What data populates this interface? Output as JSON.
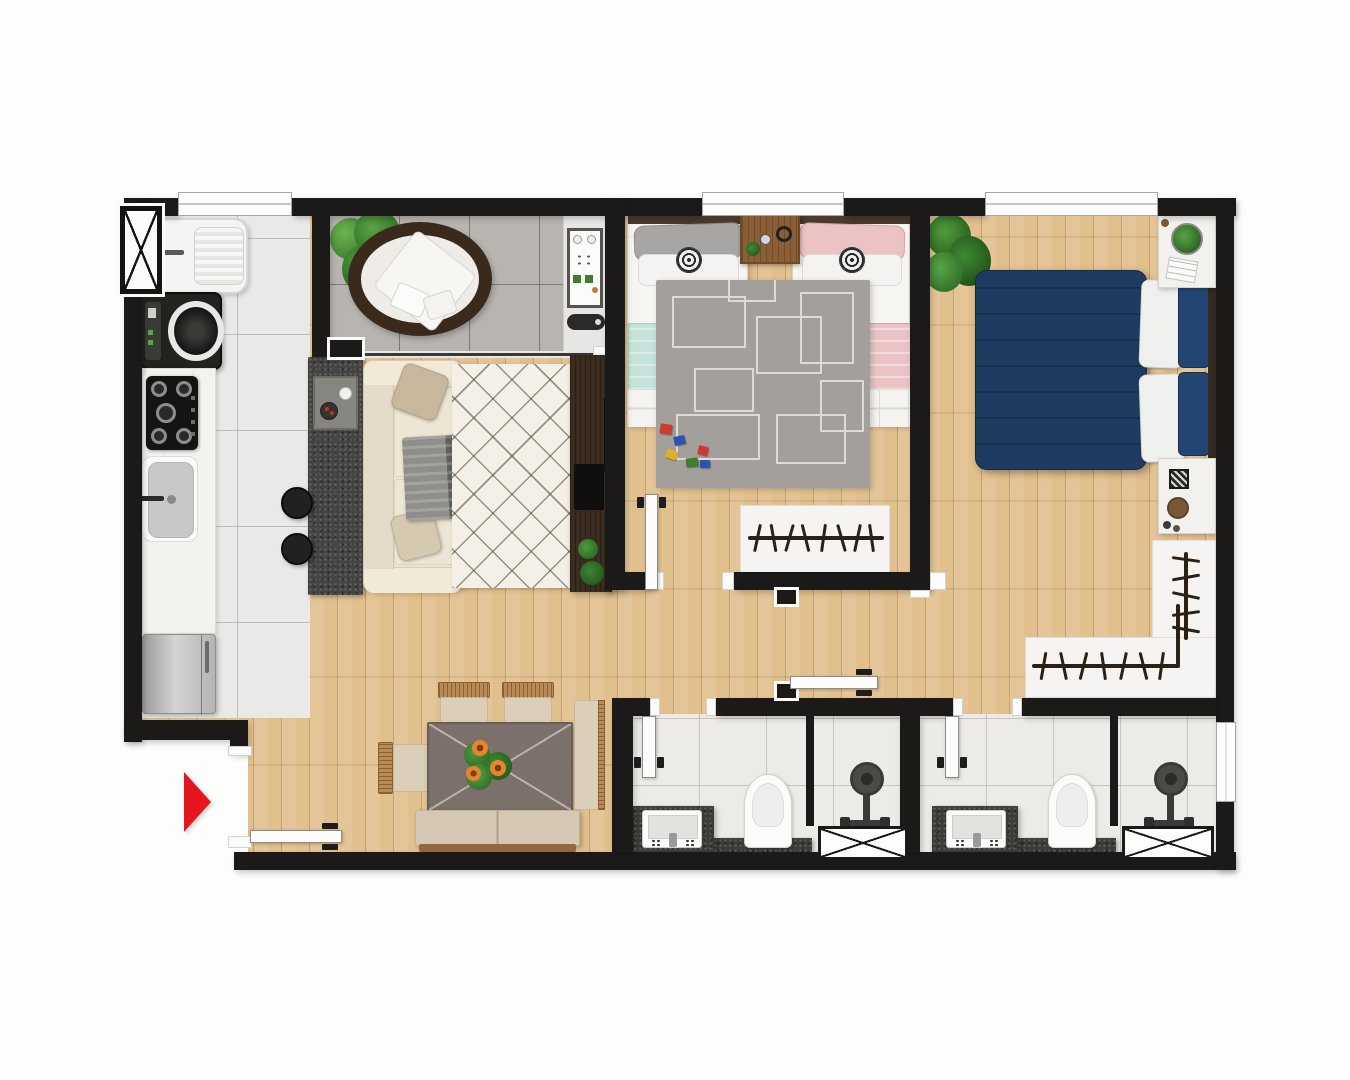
{
  "meta": {
    "title": "Top-down 3D rendered floor plan of a 2-bedroom apartment",
    "view": "top-down architectural render",
    "visible_text": "none"
  },
  "palette": {
    "wall": "#1b1a19",
    "wood_floor": "#e2c08e",
    "balcony_tile": "#b8b5b1",
    "kitchen_tile": "#ebe9e7",
    "bath_tile": "#edebe7",
    "granite_counter": "#454443",
    "navy_bed": "#1e3c61",
    "teal_blanket": "#c4e3da",
    "pink_blanket": "#eac3c4",
    "sofa_cream": "#ebe4d4",
    "entry_arrow_red": "#e5171c",
    "tv_panel_walnut": "#3a2c1f"
  },
  "entry": {
    "marker": "red-arrow",
    "direction": "pointing-right",
    "color": "#e5171c"
  },
  "rooms": [
    {
      "id": "balcony",
      "name": "balcony-terrace",
      "floor": "gray-tile",
      "items": [
        "potted-plant",
        "round-wicker-chair",
        "grill-counter",
        "grill-tool",
        "sliding-glass-door"
      ]
    },
    {
      "id": "kitchen",
      "name": "kitchen-and-laundry",
      "floor": "light-tile",
      "items": [
        "tall-casement-window",
        "laundry-tub",
        "washing-machine",
        "gas-cooktop-5-burners",
        "kitchen-sink",
        "marble-counter",
        "refrigerator",
        "granite-peninsula",
        "two-bar-stools",
        "serving-tray-with-cups"
      ]
    },
    {
      "id": "living",
      "name": "living-room",
      "floor": "wood",
      "items": [
        "three-seat-sofa",
        "two-throw-pillows",
        "gray-throw-blanket",
        "diamond-lattice-rug",
        "tv-panel",
        "tv",
        "plants"
      ]
    },
    {
      "id": "dining",
      "name": "dining-area",
      "floor": "wood",
      "items": [
        "dining-table",
        "flower-centerpiece",
        "two-wicker-chairs-top",
        "wicker-chair-left",
        "wicker-chair-right",
        "bench",
        "entry-door-open"
      ]
    },
    {
      "id": "kids",
      "name": "kids-bedroom",
      "floor": "wood",
      "items": [
        "window",
        "twin-bed-teal-gray-pillow",
        "twin-bed-pink",
        "wood-nightstand",
        "geometric-gray-rug",
        "toy-blocks",
        "open-closet-with-hangers",
        "door-open"
      ]
    },
    {
      "id": "master",
      "name": "master-bedroom",
      "floor": "wood",
      "items": [
        "window",
        "double-bed-navy-duvet",
        "white-pillows",
        "navy-pillows",
        "nightstand-with-plant-and-book",
        "nightstand-with-frame-and-tray",
        "potted-plant",
        "l-shaped-open-closet-with-hangers"
      ]
    },
    {
      "id": "bath1",
      "name": "bathroom-1",
      "items": [
        "door-open",
        "dark-vanity-counter",
        "sink",
        "toilet",
        "shower-partition",
        "shower-head",
        "duct-shaft"
      ]
    },
    {
      "id": "bath2",
      "name": "bathroom-2",
      "items": [
        "door-open",
        "dark-vanity-counter",
        "sink",
        "toilet",
        "shower-partition",
        "shower-head",
        "duct-shaft",
        "window"
      ]
    },
    {
      "id": "hall",
      "name": "hallway",
      "items": [
        "hall-door-open"
      ]
    }
  ],
  "window_count": 5,
  "door_count": 5
}
